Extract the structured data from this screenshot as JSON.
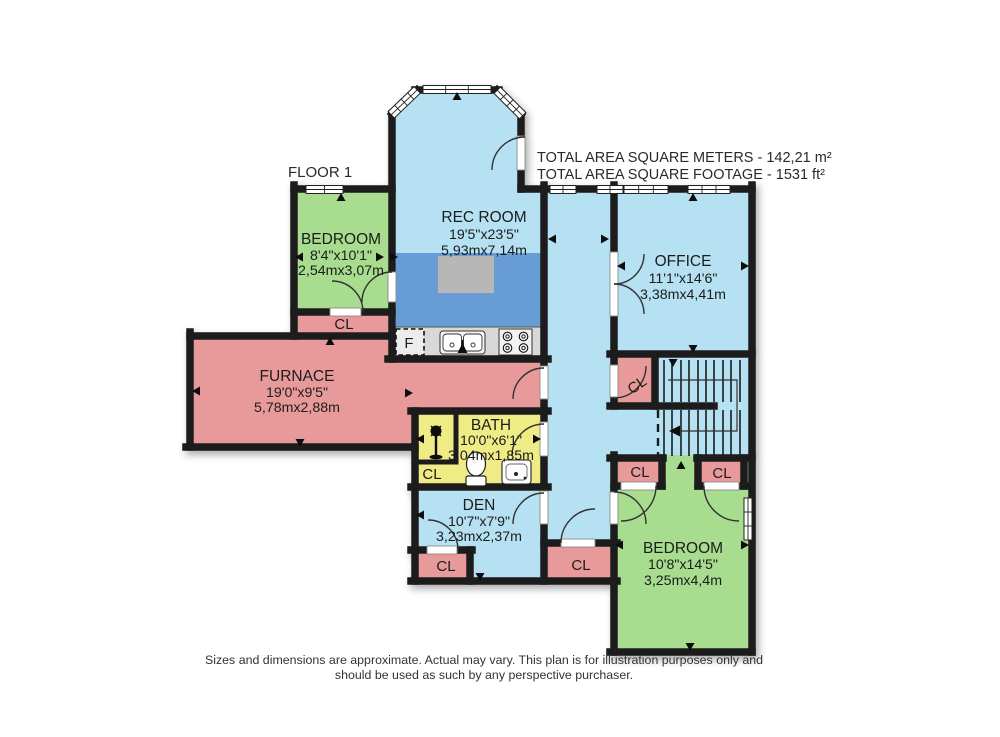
{
  "header": {
    "floor_label": "FLOOR 1",
    "total_line1": "TOTAL AREA SQUARE METERS - 142,21 m²",
    "total_line2": "TOTAL AREA SQUARE FOOTAGE  - 1531 ft²"
  },
  "rooms": {
    "rec_room": {
      "name": "REC ROOM",
      "imperial": "19'5\"x23'5\"",
      "metric": "5,93mx7,14m"
    },
    "bedroom_upper": {
      "name": "BEDROOM",
      "imperial": "8'4\"x10'1\"",
      "metric": "2,54mx3,07m"
    },
    "office": {
      "name": "OFFICE",
      "imperial": "11'1\"x14'6\"",
      "metric": "3,38mx4,41m"
    },
    "furnace": {
      "name": "FURNACE",
      "imperial": "19'0\"x9'5\"",
      "metric": "5,78mx2,88m"
    },
    "bath": {
      "name": "BATH",
      "imperial": "10'0\"x6'1\"",
      "metric": "3,04mx1,85m"
    },
    "den": {
      "name": "DEN",
      "imperial": "10'7\"x7'9\"",
      "metric": "3,23mx2,37m"
    },
    "bedroom_lower": {
      "name": "BEDROOM",
      "imperial": "10'8\"x14'5\"",
      "metric": "3,25mx4,4m"
    }
  },
  "labels": {
    "closet": "CL",
    "fridge": "F"
  },
  "footer": {
    "line1": "Sizes and dimensions are approximate. Actual may vary. This plan is for illustration purposes only and",
    "line2": "should be used as such by any perspective purchaser."
  },
  "colors": {
    "room_blue": "#b5e1f2",
    "room_green": "#a8dc8e",
    "room_pink": "#e89a9a",
    "room_yellow": "#efec86",
    "kitchen_blue": "#689cd5",
    "island_gray": "#b7b7b7",
    "counter_gray": "#d8d8d8",
    "wall_black": "#1b1b1b"
  }
}
